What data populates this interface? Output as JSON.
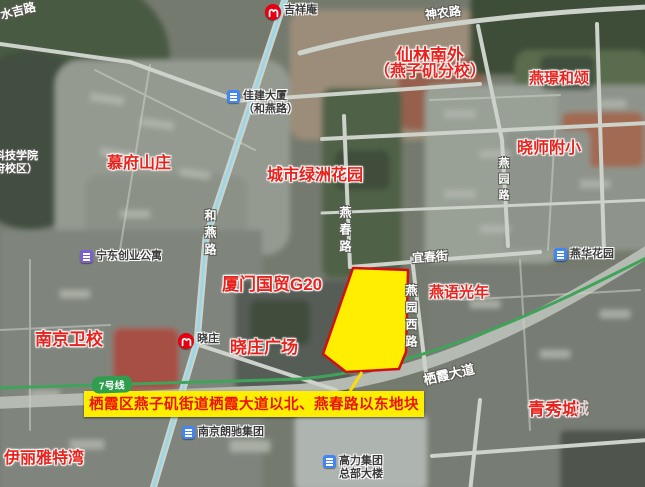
{
  "colors": {
    "parcel_fill": "#ffee00",
    "parcel_stroke": "#d01010",
    "banner_bg": "#ffee00",
    "banner_text": "#ee1100",
    "red_label": "#e8231d",
    "metro_red": "#e60012",
    "line7_green": "#2f9e4e",
    "metro_line_cyan": "#8fd9ef",
    "poi_blue": "#4285f4",
    "poi_purple": "#7a5fd0"
  },
  "banner": {
    "text": "栖霞区燕子矶街道栖霞大道以北、燕春路以东地块"
  },
  "line_badge": {
    "text": "7号线"
  },
  "red_pois": [
    {
      "text": "慕府山庄",
      "x": 107,
      "y": 156,
      "fs": 16
    },
    {
      "text": "城市绿洲花园",
      "x": 267,
      "y": 168,
      "fs": 16
    },
    {
      "text": "仙林南外",
      "x": 396,
      "y": 47,
      "fs": 17
    },
    {
      "text": "（燕子矶分校）",
      "x": 374,
      "y": 64,
      "fs": 16
    },
    {
      "text": "燕璟和颂",
      "x": 529,
      "y": 71,
      "fs": 15
    },
    {
      "text": "晓师附小",
      "x": 517,
      "y": 141,
      "fs": 16
    },
    {
      "text": "厦门国贸G20",
      "x": 222,
      "y": 276,
      "fs": 17
    },
    {
      "text": "晓庄广场",
      "x": 230,
      "y": 339,
      "fs": 17
    },
    {
      "text": "南京卫校",
      "x": 35,
      "y": 331,
      "fs": 17
    },
    {
      "text": "燕语光年",
      "x": 429,
      "y": 285,
      "fs": 15
    },
    {
      "text": "青秀城",
      "x": 528,
      "y": 401,
      "fs": 17
    },
    {
      "text": "伊丽雅特湾",
      "x": 4,
      "y": 451,
      "fs": 16
    }
  ],
  "faint_labels": [
    {
      "text": "城",
      "x": 573,
      "y": 402,
      "fs": 16
    }
  ],
  "road_labels": [
    {
      "text": "水吉路",
      "x": 0,
      "y": 5,
      "fs": 12,
      "rot": -14
    },
    {
      "text": "神农路",
      "x": 425,
      "y": 7,
      "fs": 12,
      "rot": -7
    },
    {
      "text": "宜春街",
      "x": 412,
      "y": 251,
      "fs": 12,
      "rot": -4
    },
    {
      "text": "栖霞大道",
      "x": 423,
      "y": 368,
      "fs": 13,
      "rot": -13
    },
    {
      "text": "科技学院",
      "x": -6,
      "y": 151,
      "fs": 11,
      "rot": 0
    },
    {
      "text": "府校区）",
      "x": -6,
      "y": 164,
      "fs": 11,
      "rot": 0
    }
  ],
  "vertical_road_labels": [
    {
      "text": "和燕路",
      "x": 204,
      "y": 209,
      "fs": 12
    },
    {
      "text": "燕春路",
      "x": 339,
      "y": 206,
      "fs": 12
    },
    {
      "text": "燕园路",
      "x": 497,
      "y": 157,
      "fs": 11
    },
    {
      "text": "燕园西路",
      "x": 405,
      "y": 284,
      "fs": 12
    }
  ],
  "pois": [
    {
      "icon": "metro",
      "lines": [
        "吉祥庵"
      ],
      "x": 265,
      "y": 4
    },
    {
      "icon": "metro",
      "lines": [
        "晓庄"
      ],
      "x": 178,
      "y": 333
    },
    {
      "icon": "blue",
      "lines": [
        "佳建大厦",
        "（和燕路）"
      ],
      "x": 227,
      "y": 90
    },
    {
      "icon": "purple",
      "lines": [
        "宁东创业公寓"
      ],
      "x": 80,
      "y": 250
    },
    {
      "icon": "blue",
      "lines": [
        "燕华花园"
      ],
      "x": 554,
      "y": 248
    },
    {
      "icon": "blue",
      "lines": [
        "南京朗驰集团"
      ],
      "x": 182,
      "y": 426
    },
    {
      "icon": "blue",
      "lines": [
        "高力集团",
        "总部大楼"
      ],
      "x": 323,
      "y": 455
    }
  ]
}
